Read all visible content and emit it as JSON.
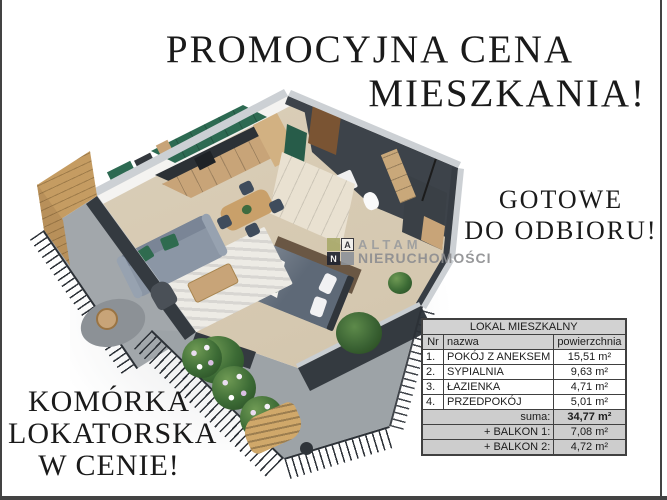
{
  "headline": {
    "line1": "PROMOCYJNA CENA",
    "line2": "MIESZKANIA!"
  },
  "ready_banner": {
    "line1": "GOTOWE",
    "line2": "DO ODBIORU!"
  },
  "storage_banner": {
    "line1": "KOMÓRKA",
    "line2": "LOKATORSKA",
    "line3": "W CENIE!"
  },
  "logo": {
    "square_a": "A",
    "square_n": "N",
    "name_top": "ALTAM",
    "name_bottom": "NIERUCHOMOŚCI"
  },
  "table": {
    "title": "LOKAL MIESZKALNY",
    "columns": {
      "nr": "Nr",
      "name": "nazwa",
      "area": "powierzchnia"
    },
    "rows": [
      {
        "nr": "1.",
        "name": "POKÓJ Z ANEKSEM",
        "area": "15,51 m²"
      },
      {
        "nr": "2.",
        "name": "SYPIALNIA",
        "area": "9,63 m²"
      },
      {
        "nr": "3.",
        "name": "ŁAZIENKA",
        "area": "4,71 m²"
      },
      {
        "nr": "4.",
        "name": "PRZEDPOKÓJ",
        "area": "5,01 m²"
      }
    ],
    "summary": [
      {
        "label": "suma:",
        "area": "34,77 m²"
      },
      {
        "label": "+ BALKON 1:",
        "area": "7,08 m²"
      },
      {
        "label": "+ BALKON 2:",
        "area": "4,72 m²"
      }
    ]
  },
  "palette": {
    "wall_dark": "#373d44",
    "wall_face": "#343a40",
    "wall_top": "#ccd0d4",
    "floor_wood": "#d8cbb4",
    "kitchen_green": "#2d6a52",
    "wood_accent": "#c8a478",
    "sofa_gray": "#8b96a5",
    "pillow_green": "#2f6b4f",
    "balcony_floor": "#a2a7ab",
    "railing": "#2c3137",
    "bed_gray": "#5e6977",
    "cream": "#e9e1d1",
    "plant_green": "#4c7a44",
    "table_header_bg": "#d2d2d2",
    "table_border": "#404040",
    "frame_border": "#434343",
    "text_black": "#1a1a1a",
    "logo_gray": "#8c8d90"
  }
}
